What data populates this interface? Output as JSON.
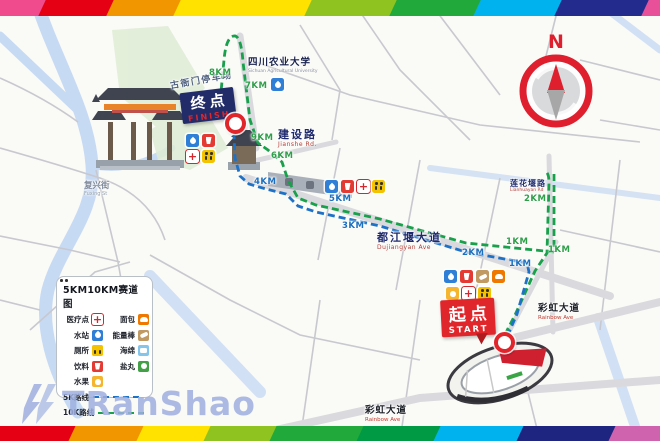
{
  "rainbow": {
    "top": [
      {
        "color": "#ef4b8d",
        "x": -8,
        "w": 56
      },
      {
        "color": "#e60013",
        "x": 42,
        "w": 74
      },
      {
        "color": "#f29600",
        "x": 110,
        "w": 73
      },
      {
        "color": "#ffe200",
        "x": 177,
        "w": 137
      },
      {
        "color": "#8fc31f",
        "x": 308,
        "w": 91
      },
      {
        "color": "#22a93c",
        "x": 393,
        "w": 90
      },
      {
        "color": "#00b3ef",
        "x": 477,
        "w": 87
      },
      {
        "color": "#232b8c",
        "x": 558,
        "w": 93
      },
      {
        "color": "#e8509a",
        "x": 645,
        "w": 30
      }
    ],
    "bottom": [
      {
        "color": "#e60013",
        "x": -8,
        "w": 86
      },
      {
        "color": "#f29600",
        "x": 72,
        "w": 74
      },
      {
        "color": "#ffe200",
        "x": 140,
        "w": 73
      },
      {
        "color": "#8fc31f",
        "x": 207,
        "w": 72
      },
      {
        "color": "#22a93c",
        "x": 273,
        "w": 93
      },
      {
        "color": "#009a44",
        "x": 360,
        "w": 83
      },
      {
        "color": "#00b3ef",
        "x": 437,
        "w": 89
      },
      {
        "color": "#1d2580",
        "x": 520,
        "w": 98
      },
      {
        "color": "#cf63ad",
        "x": 612,
        "w": 60
      }
    ]
  },
  "compass": {
    "label": "N"
  },
  "finish_marker": {
    "cn": "终点",
    "en": "FINISH"
  },
  "start_marker": {
    "cn": "起点",
    "en": "START"
  },
  "legend": {
    "title": "5KM10KM赛道图",
    "items": [
      {
        "label": "医疗点",
        "icon": "medical"
      },
      {
        "label": "面包",
        "icon": "bread"
      },
      {
        "label": "水站",
        "icon": "water"
      },
      {
        "label": "能量棒",
        "icon": "energy"
      },
      {
        "label": "厕所",
        "icon": "toilet"
      },
      {
        "label": "海绵",
        "icon": "sponge"
      },
      {
        "label": "饮料",
        "icon": "drink"
      },
      {
        "label": "盐丸",
        "icon": "salt"
      },
      {
        "label": "水果",
        "icon": "fruit"
      }
    ],
    "routes": [
      {
        "label": "5K路线",
        "color": "#1d72c8"
      },
      {
        "label": "10K路线",
        "color": "#18a04b"
      }
    ]
  },
  "km_markers": [
    {
      "text": "8KM",
      "x": 209,
      "y": 68,
      "color": "green"
    },
    {
      "text": "7KM",
      "x": 245,
      "y": 81,
      "color": "green"
    },
    {
      "text": "9KM",
      "x": 251,
      "y": 133,
      "color": "green"
    },
    {
      "text": "6KM",
      "x": 271,
      "y": 151,
      "color": "green"
    },
    {
      "text": "2KM",
      "x": 524,
      "y": 194,
      "color": "green"
    },
    {
      "text": "1KM",
      "x": 506,
      "y": 237,
      "color": "green"
    },
    {
      "text": "1KM",
      "x": 548,
      "y": 245,
      "color": "green"
    },
    {
      "text": "4KM",
      "x": 254,
      "y": 177,
      "color": "blue"
    },
    {
      "text": "5KM",
      "x": 329,
      "y": 194,
      "color": "blue"
    },
    {
      "text": "3KM",
      "x": 342,
      "y": 221,
      "color": "blue"
    },
    {
      "text": "2KM",
      "x": 462,
      "y": 248,
      "color": "blue"
    },
    {
      "text": "1KM",
      "x": 509,
      "y": 259,
      "color": "blue"
    }
  ],
  "map_icons": [
    {
      "type": "water",
      "x": 186,
      "y": 134
    },
    {
      "type": "drink",
      "x": 202,
      "y": 134
    },
    {
      "type": "medical",
      "x": 186,
      "y": 150
    },
    {
      "type": "toilet",
      "x": 202,
      "y": 150
    },
    {
      "type": "water",
      "x": 271,
      "y": 78
    },
    {
      "type": "water",
      "x": 325,
      "y": 180
    },
    {
      "type": "drink",
      "x": 341,
      "y": 180
    },
    {
      "type": "medical",
      "x": 357,
      "y": 180
    },
    {
      "type": "toilet",
      "x": 372,
      "y": 180
    },
    {
      "type": "water",
      "x": 444,
      "y": 270
    },
    {
      "type": "drink",
      "x": 460,
      "y": 270
    },
    {
      "type": "energy",
      "x": 476,
      "y": 270
    },
    {
      "type": "bread",
      "x": 492,
      "y": 270
    },
    {
      "type": "fruit",
      "x": 446,
      "y": 287
    },
    {
      "type": "medical",
      "x": 462,
      "y": 287
    },
    {
      "type": "toilet",
      "x": 478,
      "y": 287
    }
  ],
  "places": [
    {
      "cn": "古衙门停车场",
      "en": "",
      "x": 170,
      "y": 76,
      "rot": -10,
      "cls": "parking"
    },
    {
      "cn": "四川农业大学",
      "en": "Sichuan Agricultural University",
      "x": 248,
      "y": 58,
      "rot": 0,
      "cls": "poi"
    },
    {
      "cn": "建设路",
      "en": "Jianshe Rd.",
      "x": 278,
      "y": 129,
      "rot": 0,
      "cls": "road-lg"
    },
    {
      "cn": "复兴街",
      "en": "Fuxing St",
      "x": 84,
      "y": 182,
      "rot": 0,
      "cls": "minor"
    },
    {
      "cn": "都江堰大道",
      "en": "Dujiangyan Ave",
      "x": 377,
      "y": 232,
      "rot": 0,
      "cls": "road-lg"
    },
    {
      "cn": "莲花堰路",
      "en": "Lianhuayan Rd",
      "x": 510,
      "y": 179,
      "rot": 0,
      "cls": "road-md"
    },
    {
      "cn": "彩虹大道",
      "en": "Rainbow Ave",
      "x": 538,
      "y": 304,
      "rot": 0,
      "cls": "road-dark"
    },
    {
      "cn": "彩虹大道",
      "en": "Rainbow Ave",
      "x": 365,
      "y": 406,
      "rot": 0,
      "cls": "road-dark"
    }
  ],
  "watermark": {
    "text": "TRanShao"
  }
}
